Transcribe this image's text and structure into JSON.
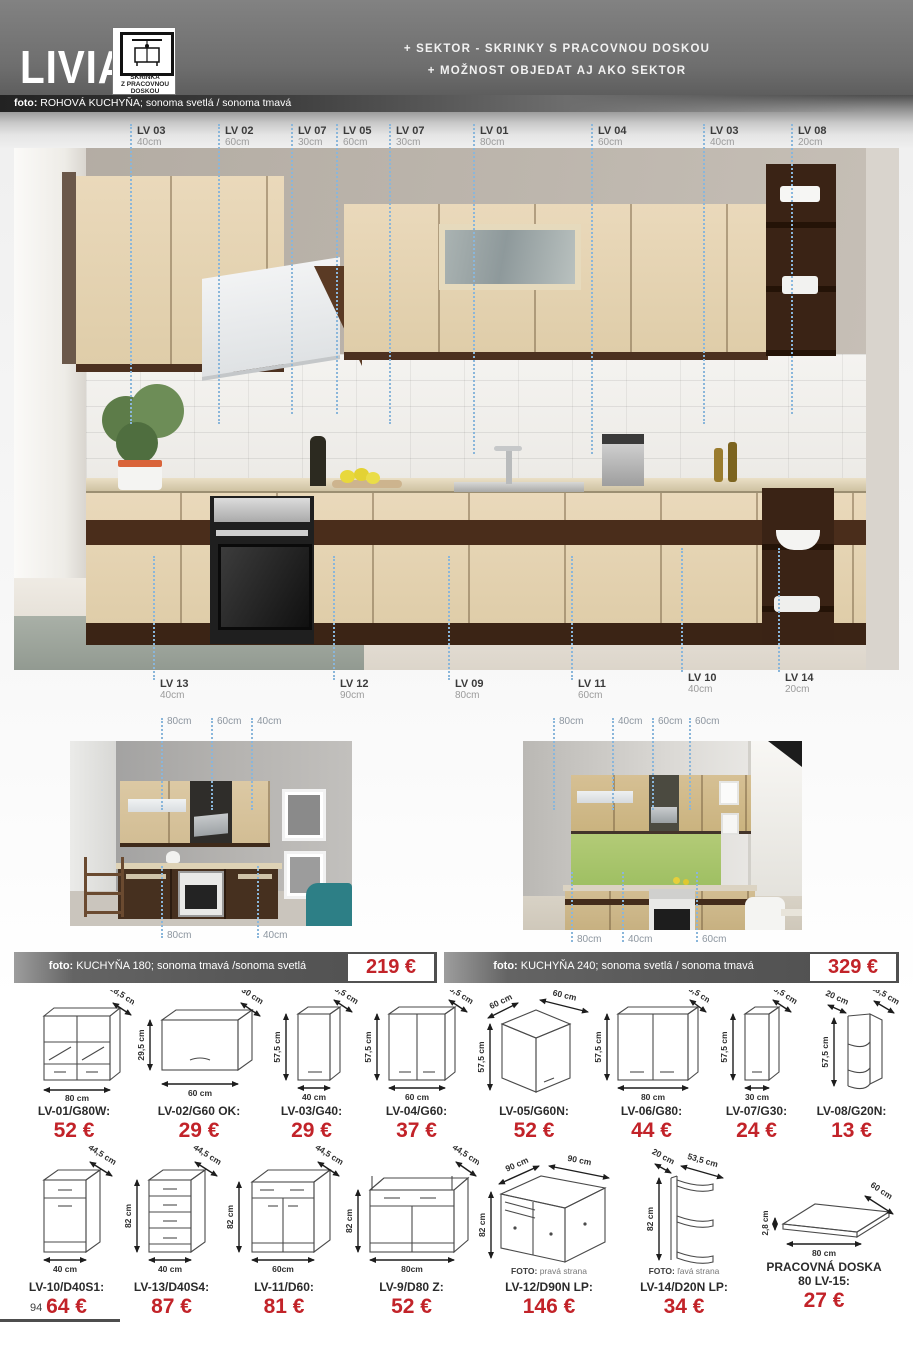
{
  "header": {
    "brand": "LIVIA",
    "badge_lines": [
      "SKRINKA",
      "Z PRACOVNOU",
      "DOSKOU"
    ],
    "tagline1": "+ SEKTOR - SKRINKY S PRACOVNOU DOSKOU",
    "tagline2": "+ MOŽNOST OBJEDAT AJ AKO SEKTOR",
    "photo_caption_label": "foto:",
    "photo_caption": " ROHOVÁ KUCHYŇA; sonoma svetlá / sonoma tmavá"
  },
  "colors": {
    "accent_red": "#c22329",
    "dotted_line": "#8ab6da"
  },
  "main_photo": {
    "top_labels": [
      {
        "code": "LV 03",
        "size": "40cm"
      },
      {
        "code": "LV 02",
        "size": "60cm"
      },
      {
        "code": "LV 07",
        "size": "30cm"
      },
      {
        "code": "LV 05",
        "size": "60cm"
      },
      {
        "code": "LV 07",
        "size": "30cm"
      },
      {
        "code": "LV 01",
        "size": "80cm"
      },
      {
        "code": "LV 04",
        "size": "60cm"
      },
      {
        "code": "LV 03",
        "size": "40cm"
      },
      {
        "code": "LV 08",
        "size": "20cm"
      }
    ],
    "bottom_labels": [
      {
        "code": "LV 13",
        "size": "40cm"
      },
      {
        "code": "LV 12",
        "size": "90cm"
      },
      {
        "code": "LV 09",
        "size": "80cm"
      },
      {
        "code": "LV 11",
        "size": "60cm"
      },
      {
        "code": "LV 10",
        "size": "40cm"
      },
      {
        "code": "LV 14",
        "size": "20cm"
      }
    ]
  },
  "photo_180": {
    "top_labels": [
      "80cm",
      "60cm",
      "40cm"
    ],
    "bottom_labels": [
      "80cm",
      "40cm"
    ]
  },
  "photo_240": {
    "top_labels": [
      "80cm",
      "40cm",
      "60cm",
      "60cm"
    ],
    "bottom_labels": [
      "80cm",
      "40cm",
      "60cm"
    ]
  },
  "banners": [
    {
      "label": "foto:",
      "text": " KUCHYŇA 180; sonoma tmavá /sonoma svetlá",
      "price": "219 €"
    },
    {
      "label": "foto:",
      "text": " KUCHYŇA 240; sonoma svetlá / sonoma tmavá",
      "price": "329 €"
    }
  ],
  "products_row1": [
    {
      "name": "LV-01/G80W:",
      "price": "52 €",
      "depth": "28,5 cm",
      "width": "80 cm"
    },
    {
      "name": "LV-02/G60 OK:",
      "price": "29 €",
      "height": "29,5 cm",
      "depth": "30 cm",
      "width": "60 cm"
    },
    {
      "name": "LV-03/G40:",
      "price": "29 €",
      "height": "57,5 cm",
      "depth": "28,5 cm",
      "width": "40 cm"
    },
    {
      "name": "LV-04/G60:",
      "price": "37 €",
      "height": "57,5 cm",
      "depth": "28,5 cm",
      "width": "60 cm"
    },
    {
      "name": "LV-05/G60N:",
      "price": "52 €",
      "height": "57,5 cm",
      "depth": "60 cm",
      "width": "60 cm"
    },
    {
      "name": "LV-06/G80:",
      "price": "44 €",
      "height": "57,5 cm",
      "depth": "28,5 cm",
      "width": "80 cm"
    },
    {
      "name": "LV-07/G30:",
      "price": "24 €",
      "height": "57,5 cm",
      "depth": "28,5 cm",
      "width": "30 cm"
    },
    {
      "name": "LV-08/G20N:",
      "price": "13 €",
      "height": "57,5 cm",
      "depth": "28,5 cm",
      "width": "20 cm"
    }
  ],
  "products_row2": [
    {
      "name": "LV-10/D40S1:",
      "price": "64 €",
      "depth": "44,5 cm",
      "width": "40 cm"
    },
    {
      "name": "LV-13/D40S4:",
      "price": "87 €",
      "height": "82 cm",
      "depth": "44,5 cm",
      "width": "40 cm"
    },
    {
      "name": "LV-11/D60:",
      "price": "81 €",
      "height": "82 cm",
      "depth": "44,5 cm",
      "width": "60cm"
    },
    {
      "name": "LV-9/D80 Z:",
      "price": "52 €",
      "height": "82 cm",
      "depth": "44,5 cm",
      "width": "80cm"
    },
    {
      "name": "LV-12/D90N LP:",
      "price": "146 €",
      "height": "82 cm",
      "depth": "90 cm",
      "width": "90 cm",
      "note_label": "FOTO:",
      "note": " pravá strana"
    },
    {
      "name": "LV-14/D20N LP:",
      "price": "34 €",
      "height": "82 cm",
      "depth": "20 cm",
      "width": "53,5 cm",
      "note_label": "FOTO:",
      "note": " ľavá strana"
    },
    {
      "name": "PRACOVNÁ DOSKA",
      "name2": "80 LV-15:",
      "price": "27 €",
      "height": "2,8 cm",
      "depth": "60 cm",
      "width": "80 cm"
    }
  ],
  "page_number": "94"
}
